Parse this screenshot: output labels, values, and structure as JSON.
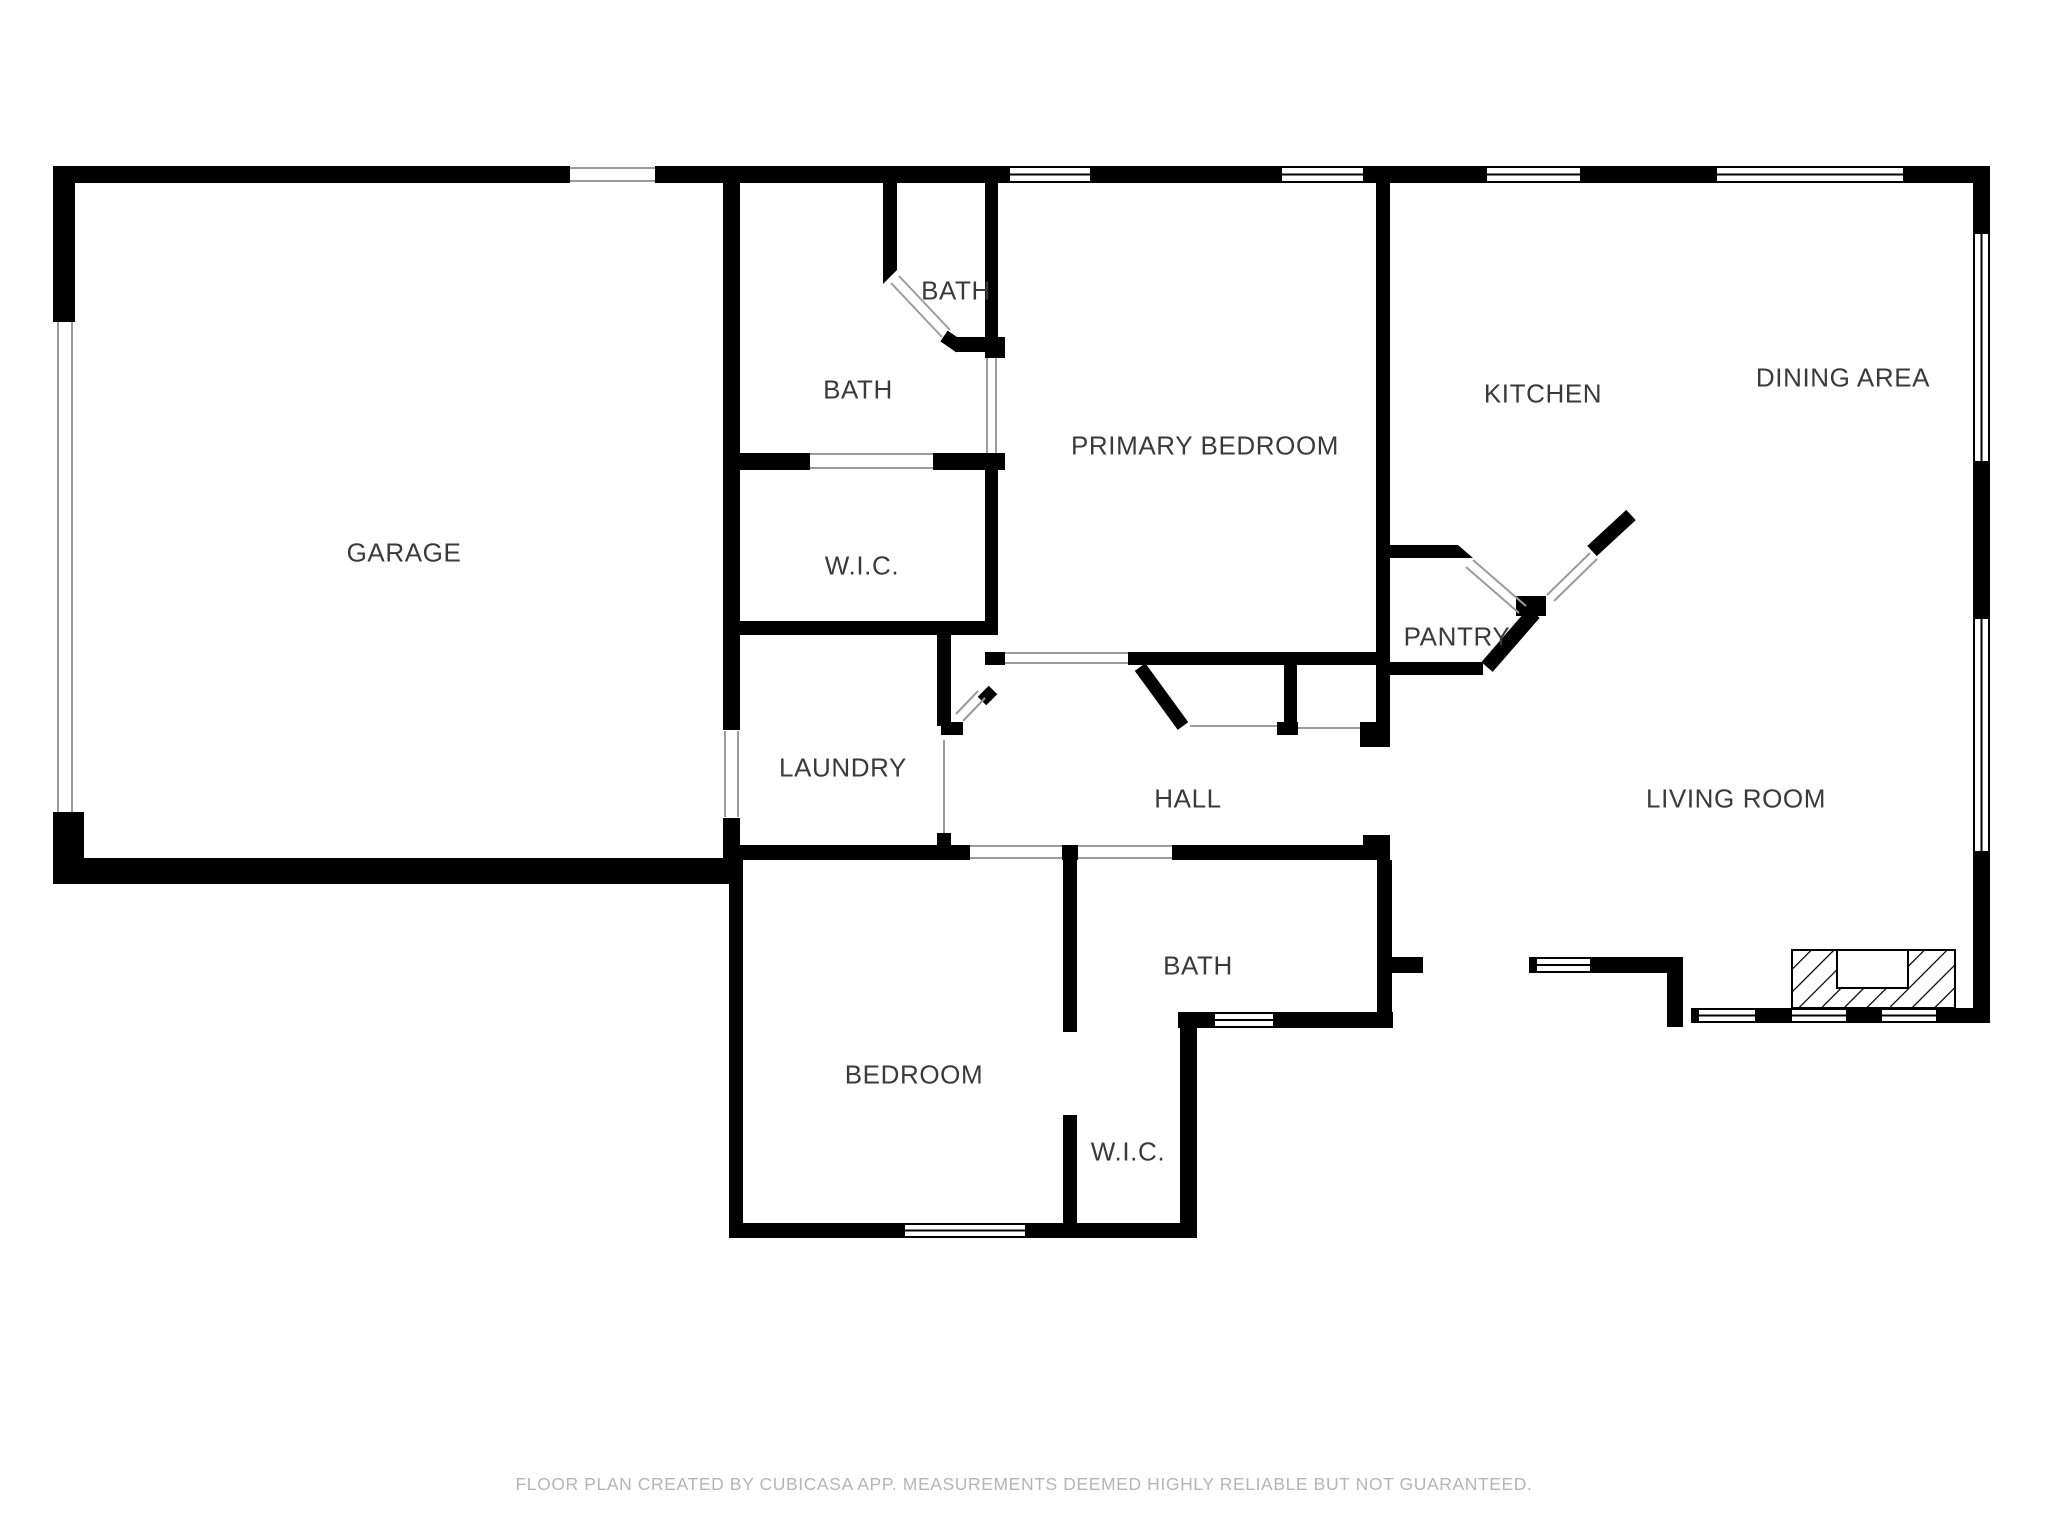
{
  "floor_plan": {
    "title": "Residential floor plan",
    "rooms": [
      {
        "id": "garage",
        "label": "GARAGE"
      },
      {
        "id": "bath-main",
        "label": "BATH"
      },
      {
        "id": "bath-toilet",
        "label": "BATH"
      },
      {
        "id": "wic-primary",
        "label": "W.I.C."
      },
      {
        "id": "laundry",
        "label": "LAUNDRY"
      },
      {
        "id": "primary-bedroom",
        "label": "PRIMARY BEDROOM"
      },
      {
        "id": "hall",
        "label": "HALL"
      },
      {
        "id": "pantry",
        "label": "PANTRY"
      },
      {
        "id": "kitchen",
        "label": "KITCHEN"
      },
      {
        "id": "dining-area",
        "label": "DINING AREA"
      },
      {
        "id": "living-room",
        "label": "LIVING ROOM"
      },
      {
        "id": "bath-hall",
        "label": "BATH"
      },
      {
        "id": "bedroom",
        "label": "BEDROOM"
      },
      {
        "id": "wic-bedroom",
        "label": "W.I.C."
      }
    ],
    "footer": {
      "disclaimer": "FLOOR PLAN CREATED BY CUBICASA APP. MEASUREMENTS DEEMED HIGHLY RELIABLE BUT NOT GUARANTEED."
    },
    "colors": {
      "wall": "#000000",
      "background": "#ffffff",
      "label_text": "#3a3a3a",
      "footer_text": "#b5b5b5",
      "opening_line": "#9b9b9b"
    }
  }
}
